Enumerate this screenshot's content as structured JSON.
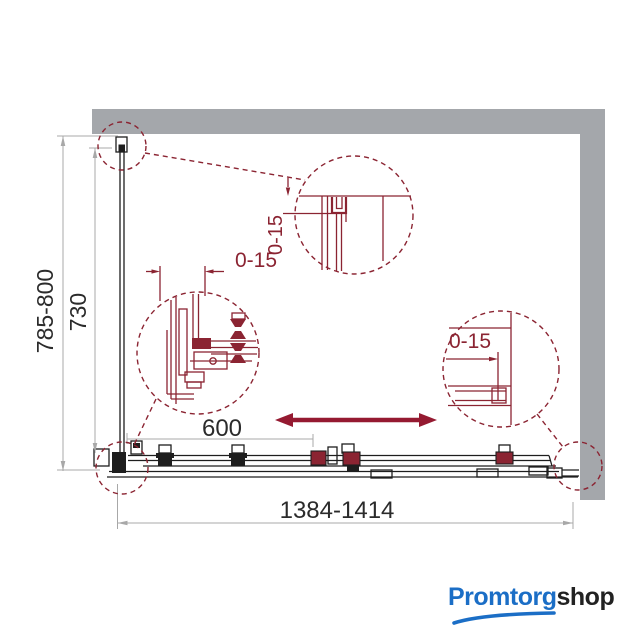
{
  "drawing": {
    "dim_height_range": "785-800",
    "dim_glass_height": "730",
    "dim_width_range": "1384-1414",
    "dim_door_travel": "600",
    "dim_adjust_top": "0-15",
    "dim_adjust_left": "0-15",
    "dim_adjust_right": "0-15"
  },
  "logo": {
    "brand_primary": "Promtorg",
    "brand_secondary": "shop"
  },
  "colors": {
    "background": "#ffffff",
    "line_black": "#1e1e1e",
    "detail_red": "#8b2432",
    "arrow_red": "#951a31",
    "wall_gray": "#a4a7ab",
    "dim_gray": "#a8a8a8",
    "text_dark": "#2b2b2b",
    "logo_blue": "#1b6ec6",
    "logo_dark": "#222222"
  }
}
